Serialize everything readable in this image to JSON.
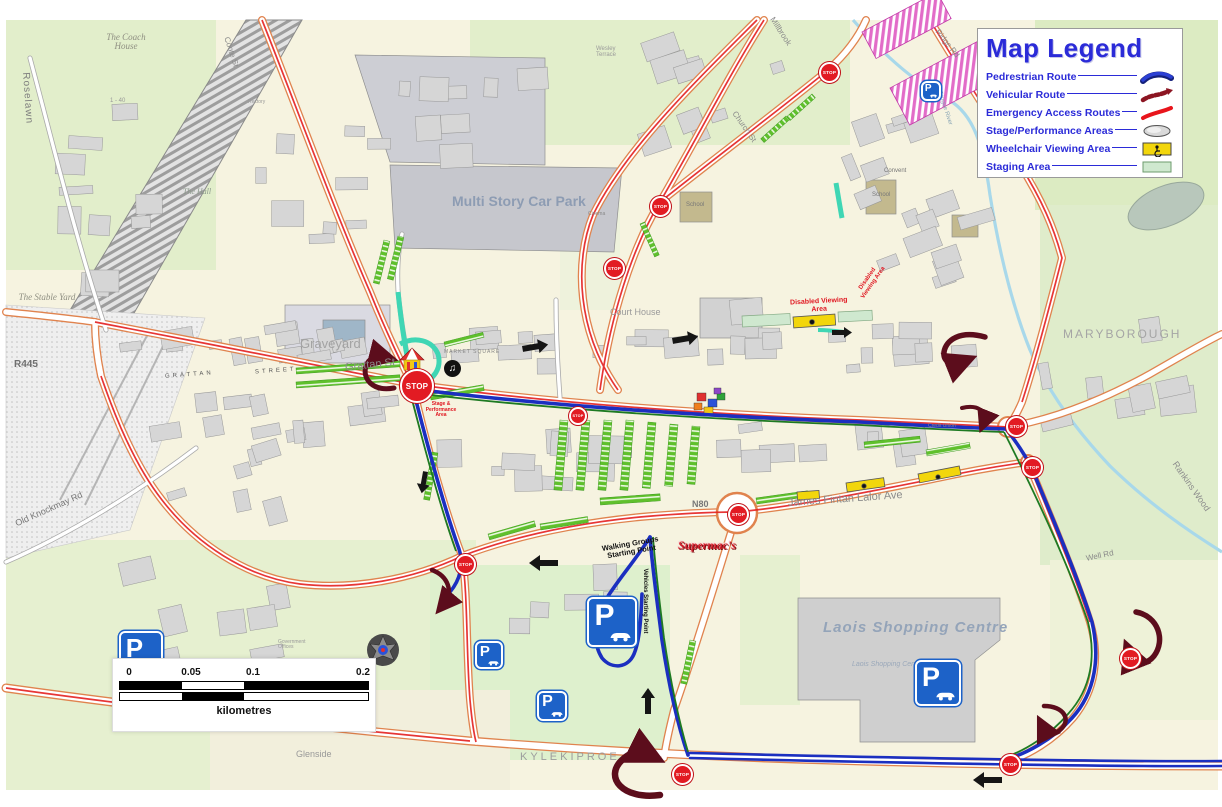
{
  "legend": {
    "title": "Map Legend",
    "items": [
      {
        "label": "Pedrestrian Route",
        "symbol": "pedestrian-line",
        "color": "#2b3fd4"
      },
      {
        "label": "Vehicular Route",
        "symbol": "vehicular-dashed-arrow",
        "color": "#8c1522"
      },
      {
        "label": "Emergency Access Routes",
        "symbol": "emergency-line",
        "color": "#e8151c"
      },
      {
        "label": "Stage/Performance Areas",
        "symbol": "stage-oval",
        "color": "#d9d9d9"
      },
      {
        "label": "Wheelchair Viewing Area",
        "symbol": "wheelchair-box",
        "color": "#f2d60c"
      },
      {
        "label": "Staging Area",
        "symbol": "staging-box",
        "color": "#cfe8cf"
      }
    ]
  },
  "scale_bar": {
    "ticks": [
      "0",
      "0.05",
      "0.1",
      "0.2"
    ],
    "unit": "kilometres"
  },
  "map": {
    "signs": {
      "stop": "STOP",
      "parking": "P"
    },
    "labels": {
      "roselawn": "Roselawn",
      "coach_house": "The Coach House",
      "stable_yard": "The Stable Yard",
      "graveyard": "Graveyard",
      "grattan_caps_1": "GRATTAN",
      "grattan_caps_2": "STREET",
      "grattan_st": "Grattan St",
      "old_knockmay": "Old Knockmay Rd",
      "r445": "R445",
      "multi_story": "Multi Story Car Park",
      "court_house": "Court House",
      "maryborough": "MARYBOROUGH",
      "rankins_wood": "Rankins Wood",
      "jfl_ave": "James Fintan Lalor Ave",
      "n80": "N80",
      "supermacs": "Supermac's",
      "laois_sc": "Laois Shopping Centre",
      "laois_sc_small": "Laois Shopping Centre",
      "kylekiproe": "KYLEKIPROE",
      "glenside": "Glenside",
      "millbrook": "Millbrook",
      "church_st": "Church St",
      "ridge_rd": "Ridge Rd",
      "wesley_terrace": "Wesley Terrace",
      "school_1": "School",
      "school_2": "School",
      "convent": "Convent",
      "market_square": "MARKET SQUARE",
      "well_rd": "Well Rd",
      "government_offices": "Government Offices",
      "credit_union": "Credit Union",
      "triogue_river": "Triogue River",
      "cinema": "Cinema",
      "rectory": "Rectory",
      "one_forty": "1 - 40",
      "the_hall": "The Hall",
      "coote_st": "Coote St"
    },
    "annotations": {
      "disabled_viewing": "Disabled Viewing Area",
      "stage_performing": "Stage & Performance Area",
      "walking_start": "Walking Groups Starting Point",
      "vehicle_start": "Vehicles Starting Point"
    },
    "colors": {
      "pedestrian_route": "#1b2fc0",
      "vehicular_route": "#5c0d1c",
      "emergency_route": "#e42020",
      "road_casing": "#e0834e",
      "wheelchair_area": "#f2d60c",
      "staging_area": "#cfe8cf",
      "carpark_row": "#5fc02c",
      "stop_sign": "#e21b23",
      "parking_sign": "#1d62c8"
    }
  }
}
